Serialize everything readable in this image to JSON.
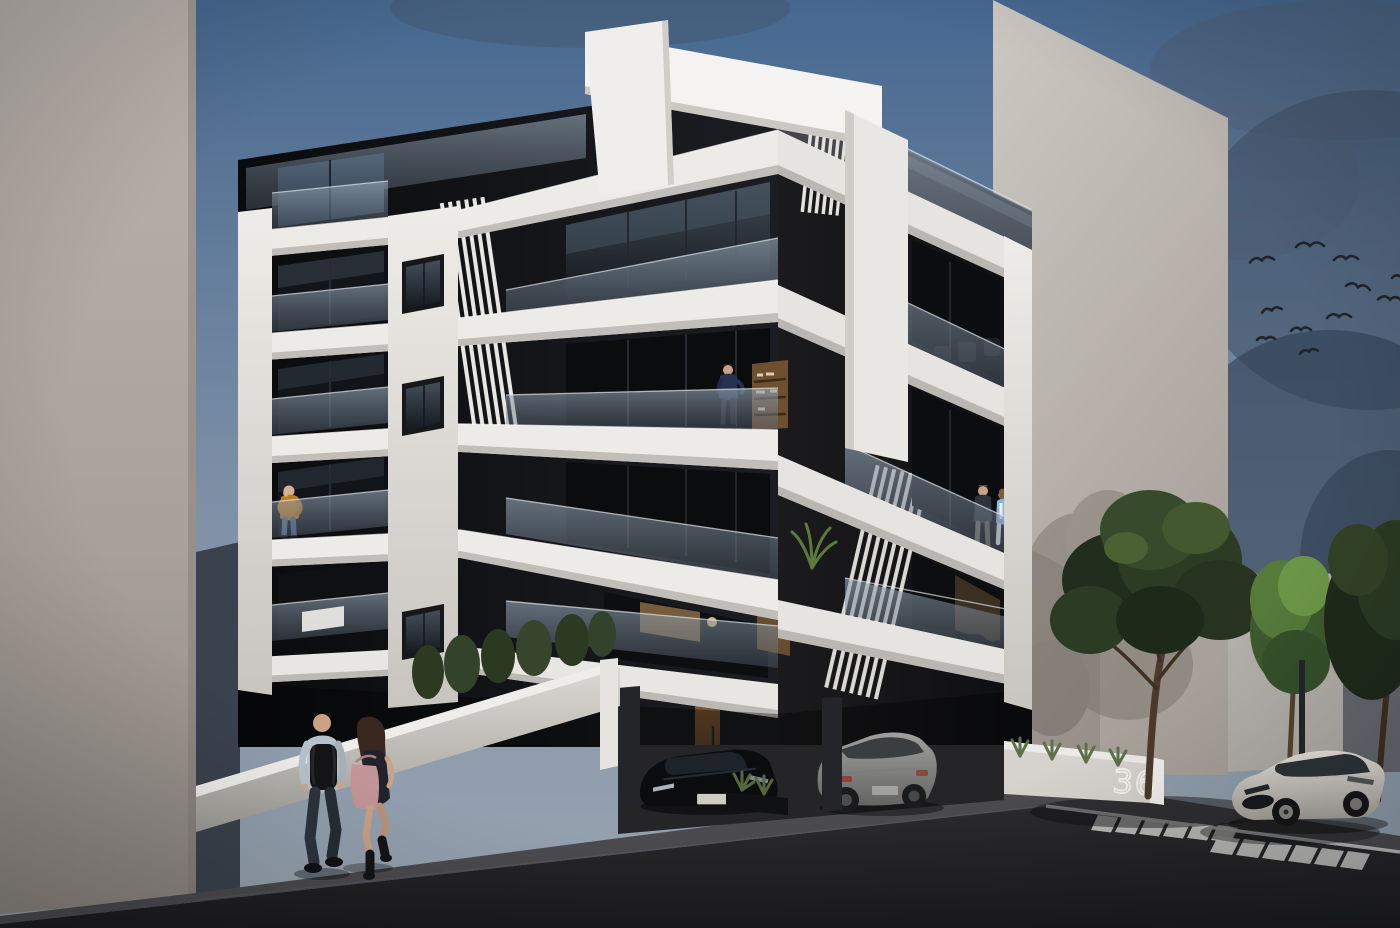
{
  "scene": {
    "type": "architectural-exterior-render",
    "subject": "modern six-level apartment building, black facade with white balcony bands and glass railings",
    "time_of_day": "dusk",
    "sign": {
      "number": "36"
    },
    "people": {
      "pedestrians": [
        "man walking with black backpack",
        "woman walking with shoulder bag"
      ],
      "balcony_residents": [
        "man in navy sweater on upper balcony",
        "man in mustard sweater drinking coffee on corner balcony",
        "couple talking on right balcony"
      ]
    },
    "vehicles": [
      "black car parked in driveway",
      "grey hatchback parked under building",
      "white sports coupe parked on street"
    ],
    "vegetation": [
      "street trees",
      "conifer hedge behind street wall",
      "agave planters"
    ],
    "birds_count": 11,
    "trees_count": 3
  },
  "colors": {
    "sky_top": "#46688f",
    "sky_horizon": "#9aa5b1",
    "cloud_dark": "#3c4c60",
    "facade_black": "#0e0f12",
    "band_white": "#efede9",
    "pier_white": "#e8e6e1",
    "glass_tint": "#8495a6",
    "neighbor_left_wall": "#b3aba4",
    "neighbor_right_wall": "#c6c1bb",
    "boundary_wall": "#b5b1ab",
    "asphalt": "#232327",
    "sidewalk": "#4a4a4e",
    "road_marking": "#d2d2cf",
    "foliage_dark": "#24301d",
    "foliage_mid": "#39502a",
    "foliage_light": "#5f8440",
    "tree_trunk": "#4a3a2b",
    "hedge_green": "#32412a",
    "door_wood": "#6f4c2c",
    "window_glow": "#caa36a",
    "sign_wall": "#d6d3ce",
    "sign_number": "#f5f4f1",
    "bird": "#20242b",
    "car_white_body": "#d8d4cd",
    "car_grey_body": "#8e8e8c",
    "car_black_body": "#0b0c0e",
    "skin": "#c9a287",
    "denim_blue": "#53688a",
    "sweater_orange": "#c07a1e",
    "sweater_navy": "#27304f",
    "blazer_blue": "#8db4dd",
    "shirt_light": "#b6c1cb",
    "bag_pink": "#c49598",
    "backpack_black": "#141416"
  }
}
